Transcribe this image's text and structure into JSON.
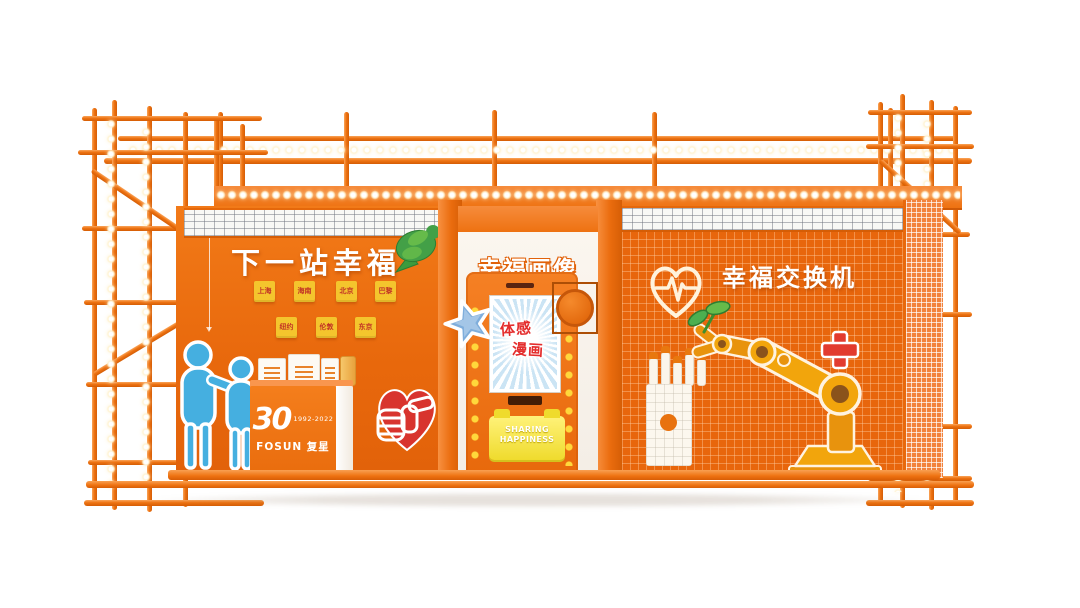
{
  "colors": {
    "orange": "#EC6C0F",
    "orange_dark": "#D55D05",
    "orange_light": "#F79A4C",
    "led_yellow": "#FFD83B",
    "note_yellow": "#F4C52D",
    "note_text": "#C23326",
    "figure_blue": "#45AFE0",
    "star_blue": "#7FAEDC",
    "heart_red": "#D8342E",
    "cross_red": "#E23B2E",
    "dove_green": "#43A047",
    "screen_text_red": "#E42D2D",
    "tray_yellow": "#EFDB2D",
    "white": "#FFFFFF"
  },
  "left_section": {
    "title": "下一站幸福",
    "notes": [
      "上海",
      "海南",
      "北京",
      "巴黎",
      "纽约",
      "伦敦",
      "东京"
    ],
    "counter": {
      "logo_number": "30",
      "logo_years": "1992-2022",
      "logo_brand": "FOSUN 复星"
    }
  },
  "middle_section": {
    "title": "幸福画像",
    "screen": {
      "line1": "体感",
      "line2": "漫画"
    },
    "tray": {
      "line1": "SHARING",
      "line2": "HAPPINESS"
    }
  },
  "right_section": {
    "title": "幸福交换机"
  }
}
